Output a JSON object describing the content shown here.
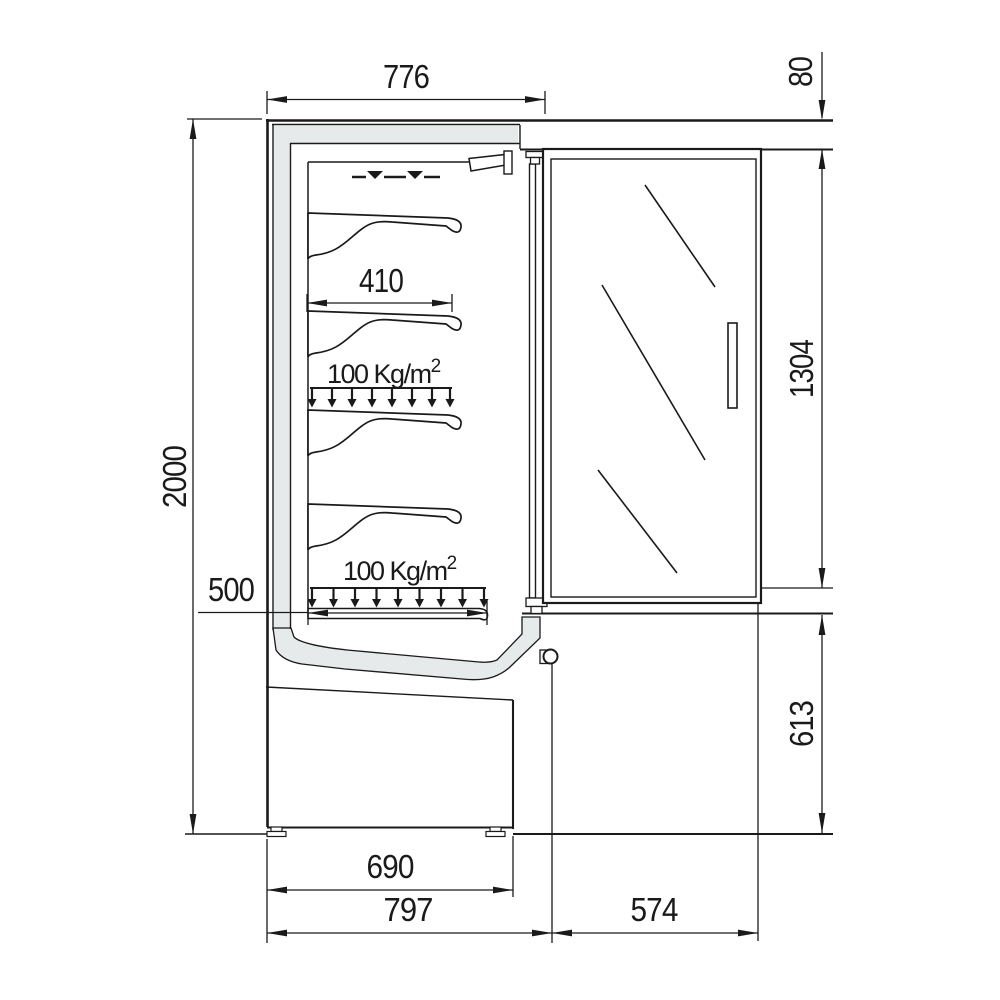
{
  "drawing": {
    "title": "refrigerated-display-cabinet-side-section",
    "units": "mm",
    "dims": {
      "top_width": "776",
      "top_gap": "80",
      "overall_height": "2000",
      "door_height": "1304",
      "lower_height": "613",
      "plinth_width": "690",
      "body_depth": "797",
      "door_swing": "574",
      "shelf_depth": "410",
      "base_shelf_depth": "500"
    },
    "load_label": {
      "base": "100 Kg/m",
      "sup": "2"
    }
  }
}
